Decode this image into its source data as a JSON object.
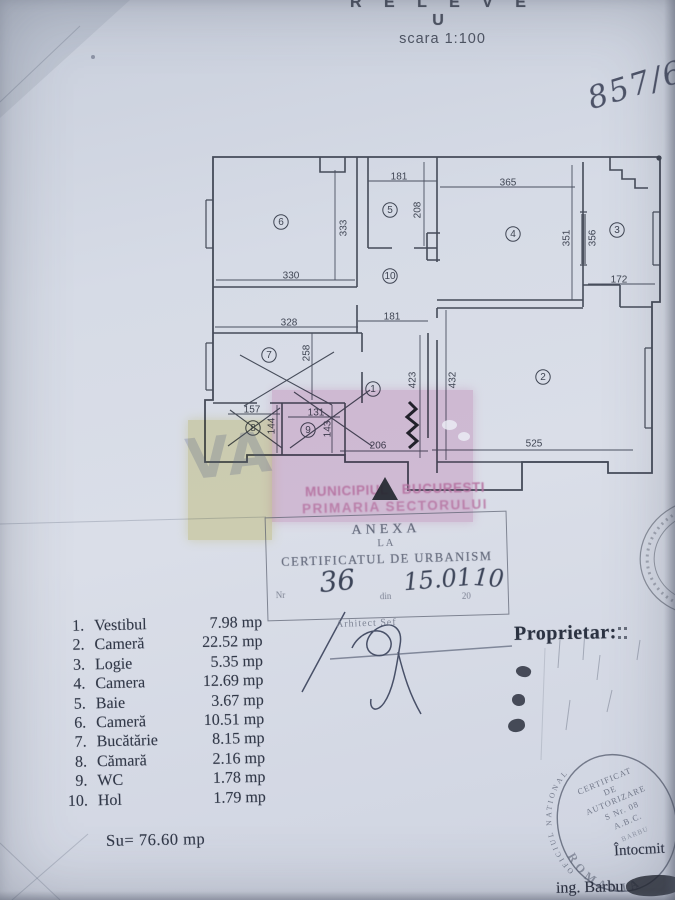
{
  "page": {
    "title": "R E L E V E U",
    "scale": "scara 1:100",
    "file_number": "857/61"
  },
  "plan": {
    "dim_labels": [
      {
        "text": "181",
        "x": 399,
        "y": 176,
        "rot": 0
      },
      {
        "text": "208",
        "x": 417,
        "y": 210,
        "rot": -90
      },
      {
        "text": "365",
        "x": 508,
        "y": 182,
        "rot": 0
      },
      {
        "text": "351",
        "x": 566,
        "y": 238,
        "rot": -90
      },
      {
        "text": "356",
        "x": 592,
        "y": 238,
        "rot": -90
      },
      {
        "text": "172",
        "x": 619,
        "y": 279,
        "rot": 0
      },
      {
        "text": "333",
        "x": 343,
        "y": 228,
        "rot": -90
      },
      {
        "text": "330",
        "x": 291,
        "y": 275,
        "rot": 0
      },
      {
        "text": "328",
        "x": 289,
        "y": 322,
        "rot": 0
      },
      {
        "text": "181",
        "x": 392,
        "y": 316,
        "rot": 0
      },
      {
        "text": "258",
        "x": 306,
        "y": 353,
        "rot": -90
      },
      {
        "text": "423",
        "x": 412,
        "y": 380,
        "rot": -90
      },
      {
        "text": "432",
        "x": 452,
        "y": 380,
        "rot": -90
      },
      {
        "text": "157",
        "x": 252,
        "y": 409,
        "rot": 0
      },
      {
        "text": "131",
        "x": 316,
        "y": 412,
        "rot": 0
      },
      {
        "text": "144",
        "x": 271,
        "y": 426,
        "rot": -90
      },
      {
        "text": "143",
        "x": 327,
        "y": 429,
        "rot": -90
      },
      {
        "text": "206",
        "x": 378,
        "y": 445,
        "rot": 0
      },
      {
        "text": "525",
        "x": 534,
        "y": 443,
        "rot": 0
      }
    ],
    "room_markers": [
      {
        "n": "1",
        "x": 373,
        "y": 389
      },
      {
        "n": "2",
        "x": 543,
        "y": 377
      },
      {
        "n": "3",
        "x": 617,
        "y": 230
      },
      {
        "n": "4",
        "x": 513,
        "y": 234
      },
      {
        "n": "5",
        "x": 390,
        "y": 210
      },
      {
        "n": "6",
        "x": 281,
        "y": 222
      },
      {
        "n": "7",
        "x": 269,
        "y": 355
      },
      {
        "n": "8",
        "x": 253,
        "y": 428
      },
      {
        "n": "9",
        "x": 308,
        "y": 430
      },
      {
        "n": "10",
        "x": 390,
        "y": 276
      }
    ]
  },
  "watermark": {
    "line1": "MUNICIPIUL BUCURESTI",
    "line2": "PRIMARIA SECTORULUI"
  },
  "anexa_stamp": {
    "title": "ANEXA",
    "subtitle": "LA",
    "doc_name": "CERTIFICATUL DE URBANISM",
    "nr_label": "Nr",
    "nr_value": "36",
    "din_label": "din",
    "date_value": "15.01",
    "year_prefix": "20",
    "year_value": "10",
    "signer_label": "Arhitect Sef"
  },
  "room_list": {
    "rows": [
      {
        "no": "1.",
        "name": "Vestibul",
        "area": "7.98 mp"
      },
      {
        "no": "2.",
        "name": "Cameră",
        "area": "22.52 mp"
      },
      {
        "no": "3.",
        "name": "Logie",
        "area": "5.35 mp"
      },
      {
        "no": "4.",
        "name": "Camera",
        "area": "12.69 mp"
      },
      {
        "no": "5.",
        "name": "Baie",
        "area": "3.67 mp"
      },
      {
        "no": "6.",
        "name": "Cameră",
        "area": "10.51 mp"
      },
      {
        "no": "7.",
        "name": "Bucătărie",
        "area": "8.15 mp"
      },
      {
        "no": "8.",
        "name": "Cămară",
        "area": "2.16 mp"
      },
      {
        "no": "9.",
        "name": "WC",
        "area": "1.78 mp"
      },
      {
        "no": "10.",
        "name": "Hol",
        "area": "1.79 mp"
      }
    ],
    "total": "Su= 76.60 mp"
  },
  "owner_label": "Proprietar:",
  "round_stamp": {
    "arc_top": "OFICIUL NATIONAL",
    "arc_bottom": "ROMANIA",
    "lines": [
      "CERTIFICAT",
      "DE",
      "AUTORIZARE",
      "S Nr. 08",
      "A.B.C.",
      "BARBU"
    ]
  },
  "footer": {
    "prepared_label": "Întocmit",
    "engineer": "ing. Barbu"
  }
}
